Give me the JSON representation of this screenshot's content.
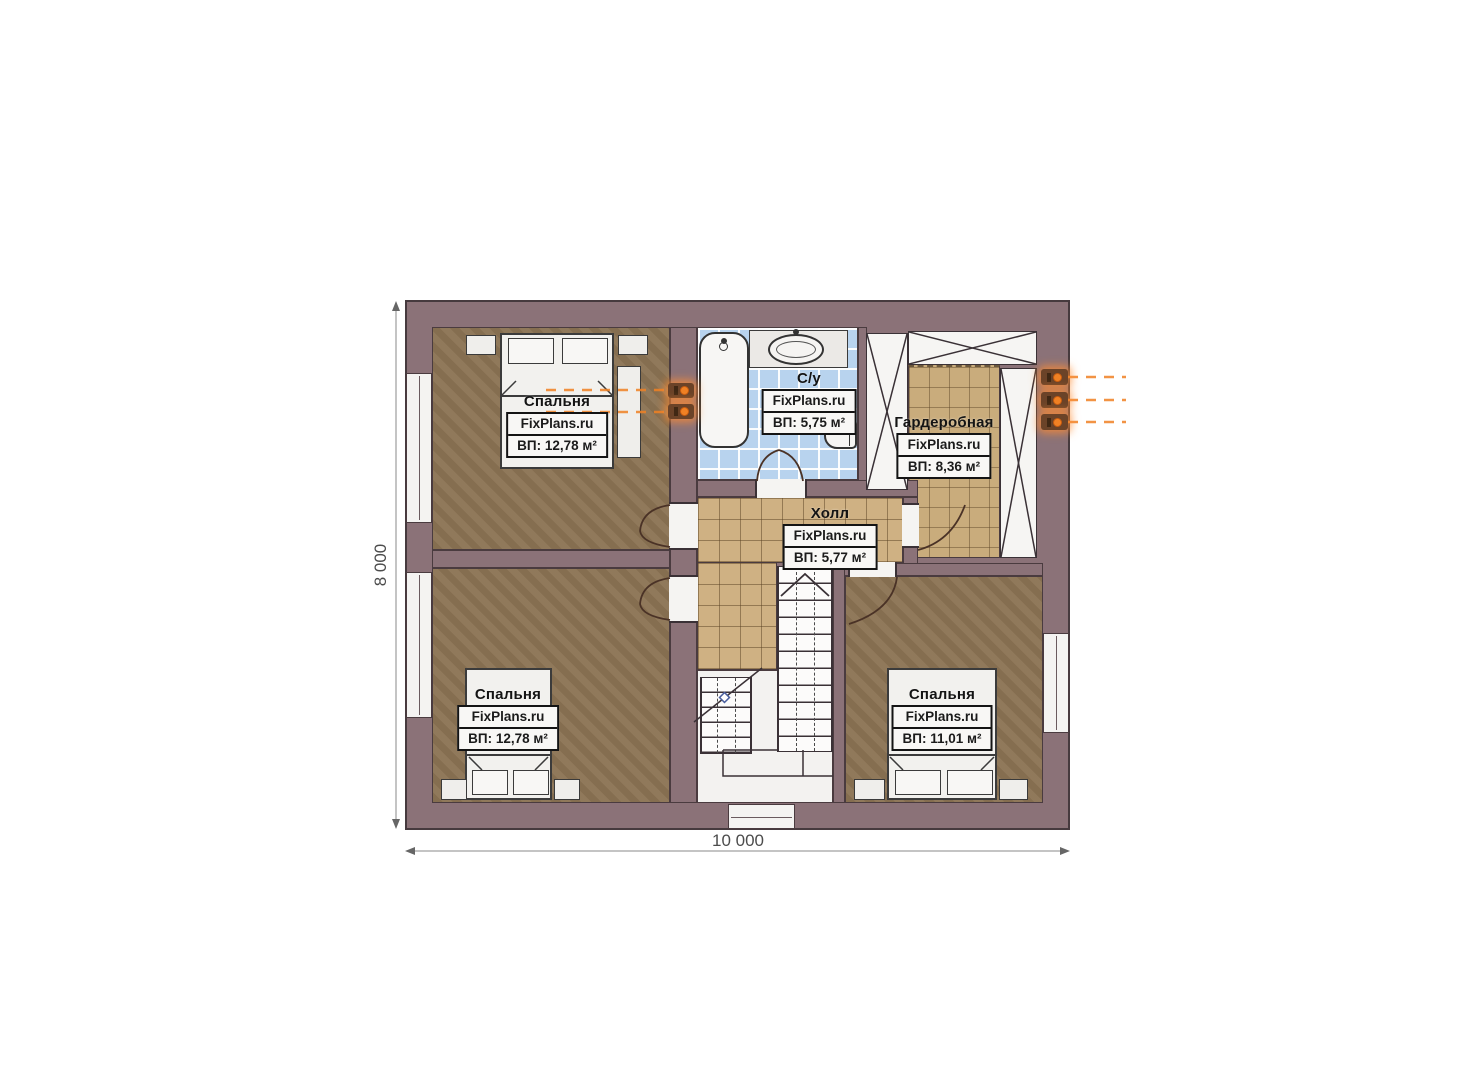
{
  "watermark_brand": "FixPlans.ru",
  "plan": {
    "dimensions": {
      "width_label": "10 000",
      "height_label": "8 000"
    },
    "rooms": [
      {
        "name": "Спальня",
        "brand": "FixPlans.ru",
        "area": "ВП: 12,78 м²"
      },
      {
        "name": "С/у",
        "brand": "FixPlans.ru",
        "area": "ВП: 5,75 м²"
      },
      {
        "name": "Гардеробная",
        "brand": "FixPlans.ru",
        "area": "ВП: 8,36 м²"
      },
      {
        "name": "Холл",
        "brand": "FixPlans.ru",
        "area": "ВП: 5,77 м²"
      },
      {
        "name": "Спальня",
        "brand": "FixPlans.ru",
        "area": "ВП: 12,78 м²"
      },
      {
        "name": "Спальня",
        "brand": "FixPlans.ru",
        "area": "ВП: 11,01 м²"
      }
    ],
    "symbols": {
      "outlet_icon": "power-outlet-icon",
      "stair_direction_icon": "stair-up-chevron-icon"
    },
    "colors": {
      "wall": "#8b7278",
      "wall_outline": "#463a3e",
      "bedroom_floor": "#8c7454",
      "hall_tile": "#cfb183",
      "wardrobe_tile": "#c9ac7c",
      "bath_tile": "#b8d3ee",
      "fixture_white": "#f2f1ee",
      "accent_orange": "#f08124",
      "stair_marker_blue": "#4a5f9e",
      "dimension_text": "#4c4c4c"
    }
  }
}
